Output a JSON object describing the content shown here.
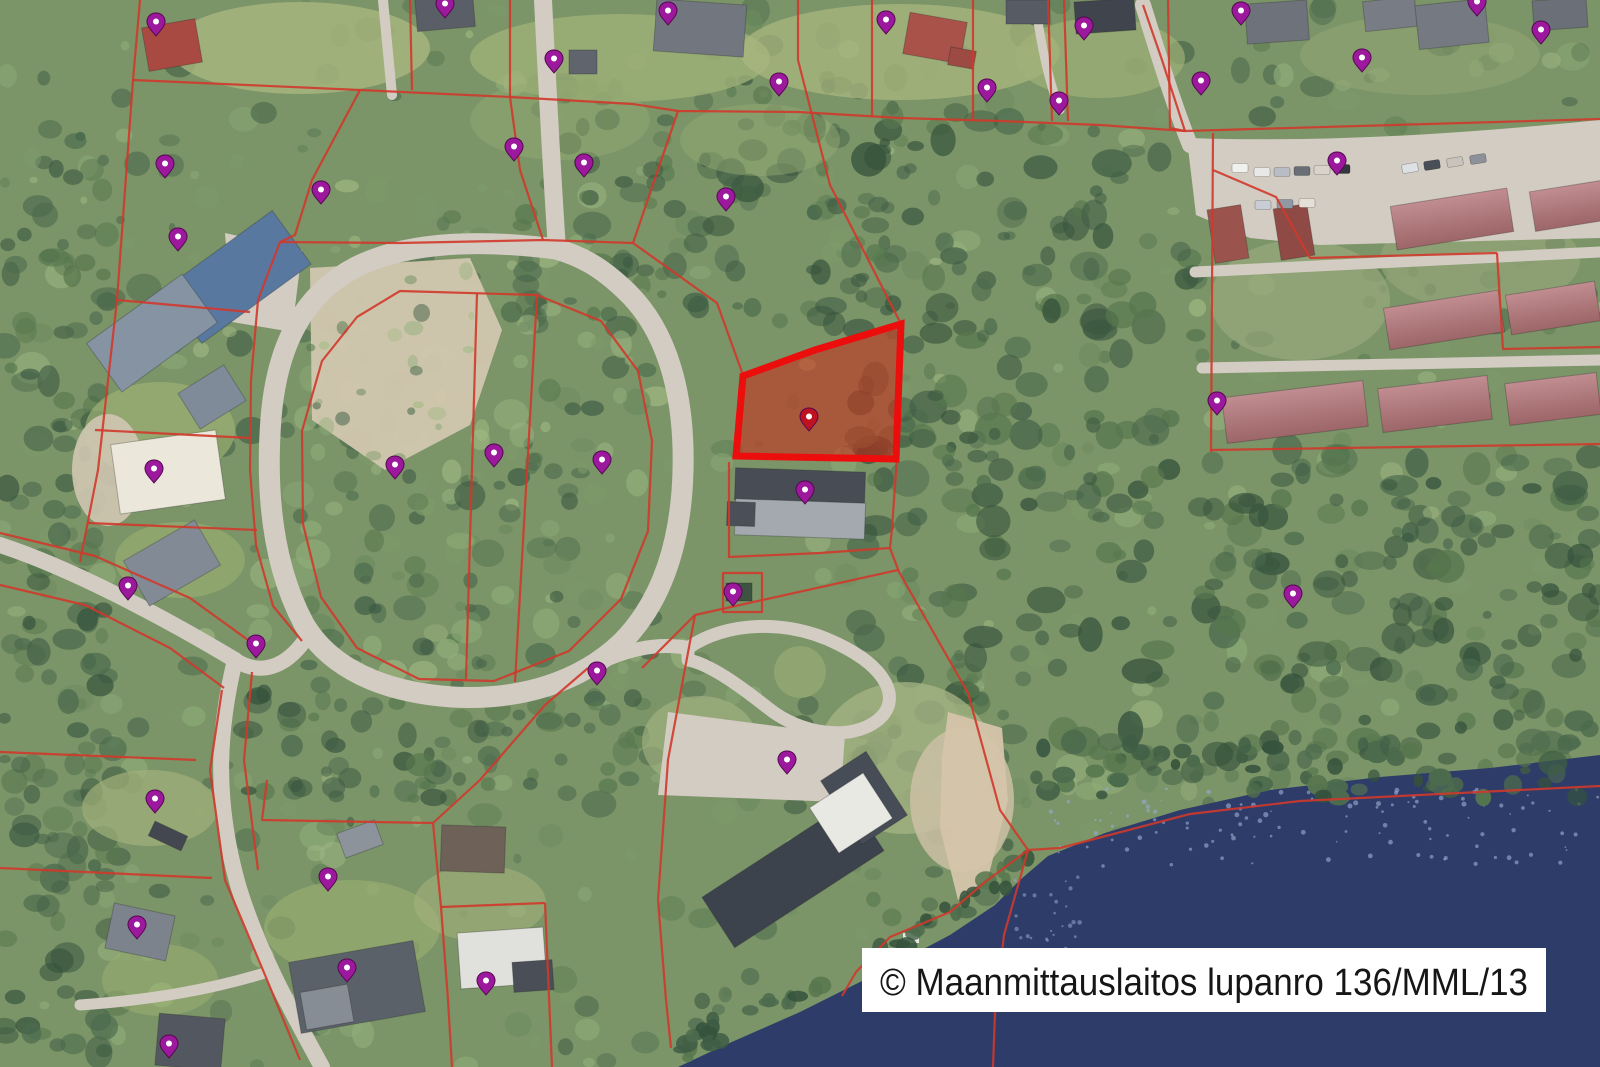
{
  "attribution": {
    "text": "© Maanmittauslaitos lupanro 136/MML/13"
  },
  "map": {
    "width": 1600,
    "height": 1067,
    "colors": {
      "forest_base": "#7b9468",
      "forest_palette": [
        "#3f5d45",
        "#4c6b4d",
        "#58784f",
        "#6b8a5e",
        "#7d9b6a",
        "#8fae79",
        "#a1ba83"
      ],
      "forest_dark": [
        "#35523c",
        "#3f5d45",
        "#4c6b4d",
        "#57774e"
      ],
      "road": "#d3ccc2",
      "sand": "#d2c7af",
      "water": "#2e3c6a",
      "water_speckle": "#95a8cb",
      "beach": "#d5c4ab",
      "parcel_line": "#d0392b",
      "highlight_stroke": "#ec0d0d",
      "highlight_fill": "rgba(206,40,22,0.55)",
      "marker": "#9c189c",
      "marker_outline": "#53094f",
      "marker_red": "#bf1220",
      "marker_hole": "#ffffff",
      "building_outline": "rgba(40,40,40,0.3)",
      "roof_red_light": "#c18d91",
      "roof_red_dark": "#9d6668",
      "label_bg": "#ffffff",
      "label_text": "#161616"
    },
    "roads": [
      {
        "name": "ring-road",
        "d": "M556,249 C470,238 402,244 356,267 C304,294 277,344 271,418 C265,498 274,568 304,624 C330,668 382,692 452,697 C522,701 581,681 621,643 C661,603 681,546 683,471 C685,396 668,331 626,291 C601,267 581,256 556,249 Z",
        "w": 21
      },
      {
        "name": "north-road",
        "d": "M543,0 C547,80 551,160 557,249",
        "w": 18
      },
      {
        "name": "west-road",
        "d": "M0,545 C70,568 160,615 235,660",
        "w": 16
      },
      {
        "name": "ring-connector",
        "d": "M235,660 C260,676 285,668 305,640",
        "w": 15
      },
      {
        "name": "south-road",
        "d": "M235,660 C218,730 214,800 238,885 C258,952 292,1012 322,1067",
        "w": 16
      },
      {
        "name": "south-branch",
        "d": "M268,972 C210,990 150,1000 80,1005",
        "w": 11
      },
      {
        "name": "school-road",
        "d": "M590,667 C625,650 655,642 688,648",
        "w": 14
      },
      {
        "name": "school-loop",
        "d": "M688,648 C725,622 786,618 838,644 C888,668 902,700 878,720 C850,742 800,734 768,708 C740,686 710,664 688,660 Z",
        "w": 13
      },
      {
        "name": "colony-access",
        "d": "M1143,5 C1160,60 1175,108 1190,145",
        "w": 16
      },
      {
        "name": "colony-top-road",
        "d": "M1190,145 C1330,150 1470,140 1600,127",
        "w": 14
      },
      {
        "name": "colony-mid-road-1",
        "d": "M1195,272 L1600,252",
        "w": 11
      },
      {
        "name": "colony-mid-road-2",
        "d": "M1202,368 L1600,360",
        "w": 11
      },
      {
        "name": "top-driveway",
        "d": "M383,0 L392,95",
        "w": 10
      },
      {
        "name": "top-driveway-2",
        "d": "M1035,0 C1040,40 1048,80 1060,110",
        "w": 9
      }
    ],
    "paved": [
      "M1188,148 L1600,132 L1600,238 L1320,245 L1250,238 L1196,215 Z",
      "M668,712 L845,735 L840,802 L658,795 Z",
      "M225,233 L302,250 L292,332 L232,322 Z"
    ],
    "clearings": [
      [
        300,
        48,
        130,
        46,
        "#a9b77f",
        0.8
      ],
      [
        620,
        58,
        150,
        44,
        "#9fb078",
        0.8
      ],
      [
        900,
        52,
        160,
        48,
        "#a9b77f",
        0.75
      ],
      [
        1100,
        58,
        85,
        40,
        "#9fb078",
        0.7
      ],
      [
        1420,
        55,
        120,
        40,
        "#93a573",
        0.6
      ],
      [
        160,
        430,
        75,
        48,
        "#9db173",
        0.7
      ],
      [
        180,
        560,
        65,
        38,
        "#9db173",
        0.6
      ],
      [
        150,
        808,
        68,
        38,
        "#a3b17b",
        0.7
      ],
      [
        352,
        928,
        88,
        48,
        "#9db173",
        0.6
      ],
      [
        480,
        903,
        66,
        38,
        "#a3b17b",
        0.6
      ],
      [
        160,
        980,
        58,
        36,
        "#9db173",
        0.5
      ],
      [
        905,
        758,
        88,
        76,
        "#a7b584",
        0.75
      ],
      [
        700,
        742,
        58,
        46,
        "#a7b584",
        0.6
      ],
      [
        1300,
        300,
        90,
        60,
        "#9aa97c",
        0.7
      ],
      [
        1480,
        260,
        100,
        50,
        "#9aa97c",
        0.6
      ],
      [
        560,
        120,
        90,
        40,
        "#94a871",
        0.5
      ],
      [
        760,
        140,
        80,
        36,
        "#94a871",
        0.5
      ],
      [
        108,
        470,
        36,
        56,
        "#d0c6b2",
        0.9
      ],
      [
        962,
        800,
        52,
        72,
        "#cdc0a4",
        0.85
      ]
    ],
    "sand_patches": [
      {
        "d": "M310,268 L470,258 L502,330 L470,425 L385,470 L312,420 Z",
        "fill": "#d2c7af"
      }
    ],
    "water": {
      "d": "M1600,755 L1490,768 L1380,777 L1270,790 L1180,810 L1105,833 L1048,856 L1020,880 L995,905 L950,935 L880,972 L800,1012 L725,1045 L678,1067 L1600,1067 Z"
    },
    "beach": {
      "d": "M948,712 L1002,728 L1008,800 L988,878 L958,900 L940,828 L942,758 Z"
    },
    "dock": {
      "x": 903,
      "y": 933,
      "w": 16,
      "h": 10
    },
    "buildings": [
      [
        445,
        12,
        58,
        34,
        -5,
        "#5a5f67"
      ],
      [
        700,
        28,
        90,
        52,
        4,
        "#72767e"
      ],
      [
        935,
        38,
        58,
        42,
        10,
        "#a8524a"
      ],
      [
        962,
        58,
        26,
        18,
        10,
        "#9c4a42"
      ],
      [
        1028,
        12,
        44,
        24,
        0,
        "#575b63"
      ],
      [
        1105,
        16,
        60,
        32,
        -4,
        "#40444c"
      ],
      [
        1277,
        22,
        62,
        40,
        -4,
        "#6e727a"
      ],
      [
        1390,
        14,
        52,
        30,
        -6,
        "#787c84"
      ],
      [
        1452,
        24,
        70,
        44,
        -6,
        "#757981"
      ],
      [
        1560,
        14,
        54,
        30,
        -4,
        "#6b6f77"
      ],
      [
        172,
        45,
        54,
        44,
        -10,
        "#a84a42"
      ],
      [
        583,
        62,
        28,
        24,
        0,
        "#60646c"
      ],
      [
        237,
        277,
        135,
        66,
        -36,
        "#5878a0"
      ],
      [
        152,
        333,
        118,
        60,
        -36,
        "#8593a3"
      ],
      [
        212,
        397,
        54,
        42,
        -32,
        "#7f8b99"
      ],
      [
        168,
        472,
        106,
        70,
        -8,
        "#ebe7da"
      ],
      [
        172,
        563,
        82,
        52,
        -30,
        "#828a95"
      ],
      [
        800,
        486,
        130,
        32,
        2,
        "#474c55"
      ],
      [
        800,
        519,
        130,
        36,
        2,
        "#a4a9b0"
      ],
      [
        741,
        514,
        28,
        24,
        2,
        "#4a4f58"
      ],
      [
        739,
        592,
        26,
        18,
        0,
        "#3e5242"
      ],
      [
        793,
        874,
        178,
        60,
        -33,
        "#3d434d"
      ],
      [
        864,
        798,
        54,
        76,
        -33,
        "#474d57"
      ],
      [
        851,
        813,
        64,
        54,
        -33,
        "#e9e9e4"
      ],
      [
        1452,
        219,
        118,
        44,
        -9,
        "colony"
      ],
      [
        1568,
        206,
        72,
        40,
        -9,
        "colony"
      ],
      [
        1294,
        232,
        34,
        52,
        -9,
        "#8f4a45"
      ],
      [
        1228,
        234,
        34,
        54,
        -9,
        "#9b544d"
      ],
      [
        1444,
        320,
        116,
        42,
        -9,
        "colony"
      ],
      [
        1553,
        308,
        90,
        40,
        -9,
        "colony"
      ],
      [
        1295,
        412,
        142,
        46,
        -7,
        "colony"
      ],
      [
        1435,
        404,
        110,
        44,
        -7,
        "colony"
      ],
      [
        1553,
        399,
        92,
        42,
        -7,
        "colony"
      ],
      [
        168,
        836,
        36,
        16,
        25,
        "#43474f"
      ],
      [
        140,
        932,
        62,
        46,
        12,
        "#7d838c"
      ],
      [
        190,
        1042,
        66,
        52,
        5,
        "#53575f"
      ],
      [
        357,
        987,
        126,
        72,
        -10,
        "#5b6169"
      ],
      [
        327,
        1007,
        48,
        38,
        -10,
        "#878d95"
      ],
      [
        502,
        958,
        86,
        56,
        -4,
        "#e0e1dd"
      ],
      [
        533,
        976,
        40,
        30,
        -4,
        "#4a4e56"
      ],
      [
        473,
        849,
        64,
        46,
        2,
        "#6d6158"
      ],
      [
        360,
        839,
        40,
        26,
        -20,
        "#8d939b"
      ]
    ],
    "cars": [
      [
        1262,
        172,
        0,
        "#e8e8e8"
      ],
      [
        1282,
        172,
        0,
        "#b8bcc4"
      ],
      [
        1302,
        171,
        0,
        "#6a6e76"
      ],
      [
        1322,
        170,
        0,
        "#d8d4cc"
      ],
      [
        1342,
        169,
        0,
        "#32363e"
      ],
      [
        1240,
        168,
        0,
        "#f0f0ee"
      ],
      [
        1263,
        205,
        0,
        "#c8ccd4"
      ],
      [
        1285,
        204,
        0,
        "#9098a4"
      ],
      [
        1307,
        203,
        0,
        "#e4e0d8"
      ],
      [
        1410,
        168,
        -9,
        "#dde0e4"
      ],
      [
        1432,
        165,
        -9,
        "#4a4e56"
      ],
      [
        1455,
        162,
        -9,
        "#c8c4bc"
      ],
      [
        1478,
        159,
        -9,
        "#8c9098"
      ]
    ],
    "parcel_lines": [
      "M140,0 L133,80 L117,300 L98,470 L80,562",
      "M133,80 L360,90 L510,97 L633,104 L678,111 L798,112 L900,118 L1000,121 L1100,125 L1185,131",
      "M410,0 L412,90",
      "M510,0 L510,97",
      "M872,0 L872,116",
      "M973,0 L973,119",
      "M1048,0 L1052,121",
      "M1064,0 L1068,121",
      "M1168,0 L1170,128 L1185,131",
      "M798,0 L798,60 L810,107",
      "M678,111 L633,243",
      "M280,242 L400,243 L543,240 L633,243",
      "M543,240 L520,170 L510,97",
      "M360,90 L312,180 L295,235 L280,242",
      "M280,242 L258,300 L251,380 L250,470 L256,545 L273,606 L302,641",
      "M117,300 L250,312",
      "M95,430 L250,438",
      "M88,523 L257,530",
      "M400,291 L537,295 L601,321 L638,371 L652,441 L648,531 L621,599 L569,651 L494,681 L419,679 L357,648 L321,597 L303,524 L302,431 L322,361 L357,317 Z",
      "M477,293 L466,679",
      "M537,295 L515,682",
      "M633,243 L717,303 L743,375",
      "M810,107 L830,185 L901,324",
      "M729,462 L729,557 L820,553 L890,548 L892,528 L897,457",
      "M723,573 L762,573 L762,612 L723,612 Z",
      "M898,570 L695,615 L642,668",
      "M695,615 L668,760 L658,900 L666,1000 L671,1048",
      "M890,548 L899,572 L968,693 L1000,810 L1028,850",
      "M1600,786 L1460,793 L1300,801 L1190,814 L1098,838 L1060,848 L1028,850",
      "M1028,850 L985,882 L950,912 L890,937 L856,972 L842,996",
      "M1028,850 L1004,935 L995,1012 L993,1067",
      "M1213,133 L1211,452",
      "M1211,450 L1600,444",
      "M1213,170 L1276,197 L1310,258",
      "M1310,258 L1497,253",
      "M1497,253 L1503,349 L1600,347",
      "M1185,131 L1600,119",
      "M1143,5 L1162,60 L1185,131",
      "M588,668 L545,705 L480,780 L433,823",
      "M267,780 L262,820 L433,823",
      "M433,823 L441,907 L448,1000 L452,1067",
      "M441,907 L545,903",
      "M545,903 L552,1067",
      "M222,690 L210,770 L225,880 L265,975 L300,1060",
      "M252,672 L244,760 L258,870",
      "M0,752 L196,760",
      "M0,868 L212,878",
      "M0,533 L95,556 L190,598 L248,640",
      "M0,585 L85,605 L170,648 L224,688"
    ],
    "highlight_parcel": {
      "d": "M736,456 L743,376 L815,350 L901,324 L896,459 Z",
      "marker": [
        809,
        419
      ]
    },
    "markers": [
      [
        156,
        24
      ],
      [
        445,
        6
      ],
      [
        668,
        13
      ],
      [
        886,
        22
      ],
      [
        1084,
        28
      ],
      [
        1241,
        13
      ],
      [
        1477,
        4
      ],
      [
        1541,
        32
      ],
      [
        1362,
        60
      ],
      [
        554,
        61
      ],
      [
        779,
        84
      ],
      [
        1201,
        83
      ],
      [
        987,
        90
      ],
      [
        1059,
        103
      ],
      [
        514,
        149
      ],
      [
        584,
        165
      ],
      [
        726,
        199
      ],
      [
        165,
        166
      ],
      [
        321,
        192
      ],
      [
        178,
        239
      ],
      [
        1337,
        163
      ],
      [
        1217,
        403
      ],
      [
        1293,
        596
      ],
      [
        395,
        467
      ],
      [
        494,
        455
      ],
      [
        602,
        462
      ],
      [
        154,
        471
      ],
      [
        128,
        588
      ],
      [
        256,
        646
      ],
      [
        597,
        673
      ],
      [
        805,
        492
      ],
      [
        733,
        594
      ],
      [
        787,
        762
      ],
      [
        155,
        801
      ],
      [
        137,
        927
      ],
      [
        328,
        879
      ],
      [
        347,
        970
      ],
      [
        486,
        983
      ],
      [
        169,
        1046
      ]
    ],
    "label_box": {
      "x": 862,
      "y": 948,
      "w": 684,
      "h": 64
    }
  }
}
